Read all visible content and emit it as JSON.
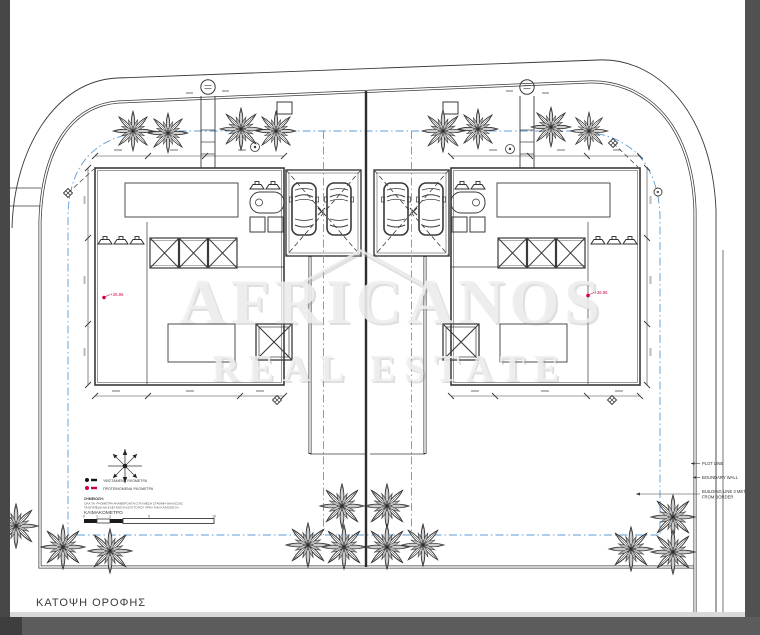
{
  "drawing": {
    "title": "ΚΑΤΟΨΗ ΟΡΟΦΗΣ",
    "watermark": {
      "line1": "AFRICANOS",
      "line2": "REAL ESTATE"
    },
    "elevations": {
      "left": "+26.95",
      "right": "+26.95"
    },
    "side_labels": {
      "plot_line": "PLOT LINE",
      "boundary_wall": "BOUNDARY WALL",
      "building_line_line1": "BUILDING LINE 3 METERS",
      "building_line_line2": "FROM BORDER"
    },
    "legend": {
      "item_existing": "ΥΦΙΣΤΑΜΕΝΑ ΥΨΟΜΕΤΡΑ",
      "item_proposed": "ΠΡΟΤΕΙΝΟΜΕΝΑ ΥΨΟΜΕΤΡΑ",
      "note_title": "ΣΗΜΕΙΩΣΗ:",
      "note_line1": "ΟΛΑ ΤΑ ΥΨΟΜΕΤΡΑ ΑΝΑΦΕΡΟΝΤΑΙ ΣΤΗ ΜΕΣΗ ΣΤΑΘΜΗ ΘΑΛΑΣΣΑΣ",
      "note_line2": "ΤΑ ΕΠΙΠΕΔΑ ΝΑ ΕΛΕΓΧΘΟΥΝ ΕΠΙ ΤΟΠΟΥ ΠΡΙΝ ΤΗΝ ΚΑΤΑΣΚΕΥΗ",
      "scale_label": "ΚΛΙΜΑΚΟΜΕΤΡΟ",
      "ticks": [
        "0",
        "1",
        "2",
        "5",
        "10"
      ]
    },
    "colors": {
      "paper": "#ffffff",
      "frame": "#565656",
      "ink": "#3a3a3a",
      "guide_blue": "#5b9bd5",
      "accent_red": "#d10045"
    }
  }
}
